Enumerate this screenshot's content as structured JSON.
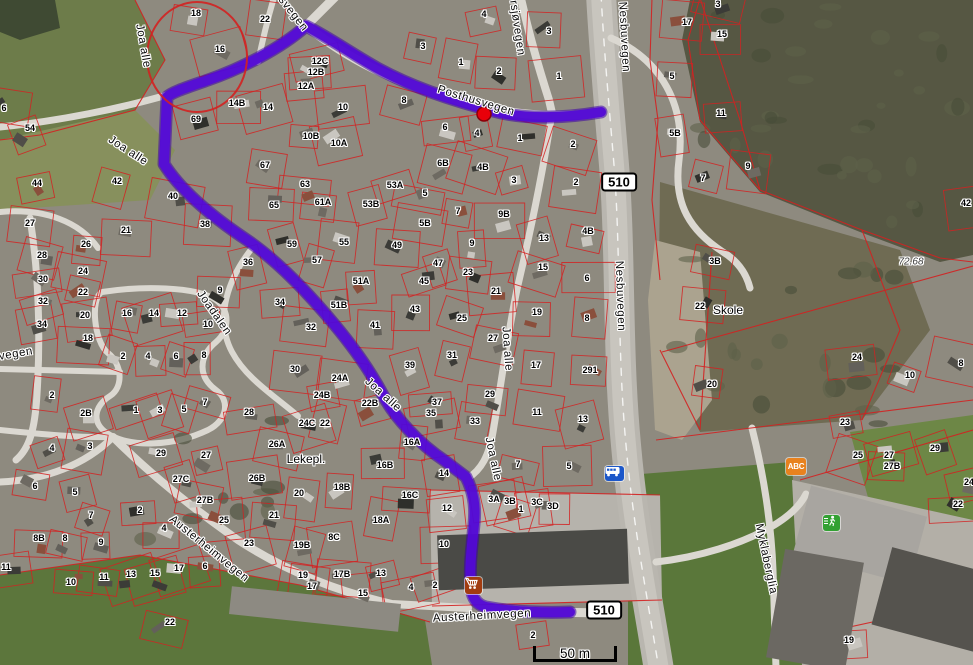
{
  "map": {
    "colors": {
      "route": "#5309d6",
      "route_casing": "#3c00a8",
      "parcel_line": "#d32121",
      "annotation_circle": "#d32121",
      "marker": "#e8000a"
    },
    "streets": [
      {
        "t": "Joa alle",
        "x": 143,
        "y": 46,
        "r": 80
      },
      {
        "t": "Joa alle",
        "x": 128,
        "y": 151,
        "r": 33
      },
      {
        "t": "svegen",
        "x": 293,
        "y": 14,
        "r": 52
      },
      {
        "t": "rsjøvegen",
        "x": 517,
        "y": 28,
        "r": 82
      },
      {
        "t": "Nesbuvegen",
        "x": 624,
        "y": 37,
        "r": 87
      },
      {
        "t": "Posthusvegen",
        "x": 476,
        "y": 101,
        "r": 17
      },
      {
        "t": "vegen",
        "x": 16,
        "y": 354,
        "r": -10
      },
      {
        "t": "Joadalen",
        "x": 214,
        "y": 313,
        "r": 55
      },
      {
        "t": "Joa alle",
        "x": 383,
        "y": 395,
        "r": 42
      },
      {
        "t": "Joa alle",
        "x": 507,
        "y": 349,
        "r": 86
      },
      {
        "t": "Nesbuvegen",
        "x": 620,
        "y": 296,
        "r": 88
      },
      {
        "t": "Joa alle",
        "x": 493,
        "y": 459,
        "r": 78
      },
      {
        "t": "Austerheimvegen",
        "x": 209,
        "y": 549,
        "r": 39
      },
      {
        "t": "Austerheimvegen",
        "x": 482,
        "y": 616,
        "r": -3
      },
      {
        "t": "Myklaberglia",
        "x": 766,
        "y": 559,
        "r": 78
      }
    ],
    "places": [
      {
        "t": "Skole",
        "x": 728,
        "y": 310
      },
      {
        "t": "Lekepl.",
        "x": 306,
        "y": 459
      },
      {
        "t": "72.68",
        "x": 911,
        "y": 262,
        "italic": true
      }
    ],
    "route_shields": [
      {
        "label": "510",
        "x": 619,
        "y": 182
      },
      {
        "label": "510",
        "x": 604,
        "y": 610
      }
    ],
    "icons": {
      "bus_stop": {
        "x": 605,
        "y": 466,
        "color": "#1c57c9"
      },
      "shop": {
        "x": 465,
        "y": 577,
        "color": "#a23c10"
      },
      "kindergarten": {
        "x": 786,
        "y": 458,
        "color": "#e8821e",
        "label": "ABC"
      },
      "sports": {
        "x": 823,
        "y": 515,
        "color": "#33a133"
      }
    },
    "scale_bar": {
      "label": "50 m",
      "x": 533,
      "y": 640,
      "width": 84
    },
    "marker": {
      "x": 484,
      "y": 114
    },
    "annotation_circle": {
      "cx": 197,
      "cy": 57,
      "rx": 50,
      "ry": 55
    },
    "house_numbers": [
      {
        "t": "18",
        "x": 196,
        "y": 13
      },
      {
        "t": "22",
        "x": 265,
        "y": 19
      },
      {
        "t": "16",
        "x": 220,
        "y": 49
      },
      {
        "t": "12C",
        "x": 320,
        "y": 61
      },
      {
        "t": "12B",
        "x": 316,
        "y": 72
      },
      {
        "t": "12A",
        "x": 306,
        "y": 86
      },
      {
        "t": "14B",
        "x": 237,
        "y": 103
      },
      {
        "t": "14",
        "x": 268,
        "y": 107
      },
      {
        "t": "69",
        "x": 196,
        "y": 119
      },
      {
        "t": "10B",
        "x": 311,
        "y": 136
      },
      {
        "t": "54",
        "x": 30,
        "y": 128
      },
      {
        "t": "44",
        "x": 37,
        "y": 183
      },
      {
        "t": "42",
        "x": 117,
        "y": 181
      },
      {
        "t": "40",
        "x": 173,
        "y": 196
      },
      {
        "t": "67",
        "x": 265,
        "y": 165
      },
      {
        "t": "63",
        "x": 305,
        "y": 184
      },
      {
        "t": "65",
        "x": 274,
        "y": 205
      },
      {
        "t": "61A",
        "x": 323,
        "y": 202
      },
      {
        "t": "6",
        "x": 4,
        "y": 108
      },
      {
        "t": "4",
        "x": 484,
        "y": 14
      },
      {
        "t": "3",
        "x": 423,
        "y": 46
      },
      {
        "t": "3",
        "x": 549,
        "y": 31
      },
      {
        "t": "1",
        "x": 461,
        "y": 62
      },
      {
        "t": "2",
        "x": 499,
        "y": 71
      },
      {
        "t": "1",
        "x": 559,
        "y": 76
      },
      {
        "t": "2",
        "x": 573,
        "y": 144
      },
      {
        "t": "8",
        "x": 404,
        "y": 100
      },
      {
        "t": "10",
        "x": 343,
        "y": 107
      },
      {
        "t": "10A",
        "x": 339,
        "y": 143
      },
      {
        "t": "6",
        "x": 445,
        "y": 127
      },
      {
        "t": "4",
        "x": 477,
        "y": 133
      },
      {
        "t": "1",
        "x": 520,
        "y": 138
      },
      {
        "t": "6B",
        "x": 443,
        "y": 163
      },
      {
        "t": "4B",
        "x": 483,
        "y": 167
      },
      {
        "t": "3",
        "x": 514,
        "y": 180
      },
      {
        "t": "2",
        "x": 576,
        "y": 182
      },
      {
        "t": "53A",
        "x": 395,
        "y": 185
      },
      {
        "t": "53B",
        "x": 371,
        "y": 204
      },
      {
        "t": "5",
        "x": 425,
        "y": 193
      },
      {
        "t": "7",
        "x": 458,
        "y": 211
      },
      {
        "t": "9B",
        "x": 504,
        "y": 214
      },
      {
        "t": "3",
        "x": 718,
        "y": 4
      },
      {
        "t": "17",
        "x": 687,
        "y": 22
      },
      {
        "t": "15",
        "x": 722,
        "y": 34
      },
      {
        "t": "5",
        "x": 672,
        "y": 76
      },
      {
        "t": "11",
        "x": 721,
        "y": 113
      },
      {
        "t": "5B",
        "x": 675,
        "y": 133
      },
      {
        "t": "9",
        "x": 748,
        "y": 166
      },
      {
        "t": "7",
        "x": 703,
        "y": 178
      },
      {
        "t": "42",
        "x": 966,
        "y": 203
      },
      {
        "t": "27",
        "x": 30,
        "y": 223
      },
      {
        "t": "21",
        "x": 126,
        "y": 230
      },
      {
        "t": "38",
        "x": 205,
        "y": 224
      },
      {
        "t": "26",
        "x": 86,
        "y": 244
      },
      {
        "t": "28",
        "x": 42,
        "y": 255
      },
      {
        "t": "59",
        "x": 292,
        "y": 244
      },
      {
        "t": "57",
        "x": 317,
        "y": 260
      },
      {
        "t": "24",
        "x": 83,
        "y": 271
      },
      {
        "t": "30",
        "x": 43,
        "y": 279
      },
      {
        "t": "36",
        "x": 248,
        "y": 262
      },
      {
        "t": "22",
        "x": 83,
        "y": 292
      },
      {
        "t": "32",
        "x": 43,
        "y": 301
      },
      {
        "t": "20",
        "x": 85,
        "y": 315
      },
      {
        "t": "34",
        "x": 42,
        "y": 324
      },
      {
        "t": "9",
        "x": 220,
        "y": 290
      },
      {
        "t": "18",
        "x": 88,
        "y": 338
      },
      {
        "t": "16",
        "x": 127,
        "y": 313
      },
      {
        "t": "14",
        "x": 154,
        "y": 313
      },
      {
        "t": "12",
        "x": 182,
        "y": 313
      },
      {
        "t": "10",
        "x": 208,
        "y": 324
      },
      {
        "t": "34",
        "x": 280,
        "y": 302
      },
      {
        "t": "32",
        "x": 311,
        "y": 327
      },
      {
        "t": "2",
        "x": 123,
        "y": 356
      },
      {
        "t": "4",
        "x": 148,
        "y": 356
      },
      {
        "t": "6",
        "x": 176,
        "y": 356
      },
      {
        "t": "8",
        "x": 204,
        "y": 355
      },
      {
        "t": "30",
        "x": 295,
        "y": 369
      },
      {
        "t": "2",
        "x": 52,
        "y": 395
      },
      {
        "t": "2B",
        "x": 86,
        "y": 413
      },
      {
        "t": "1",
        "x": 136,
        "y": 410
      },
      {
        "t": "3",
        "x": 160,
        "y": 410
      },
      {
        "t": "5",
        "x": 184,
        "y": 409
      },
      {
        "t": "7",
        "x": 205,
        "y": 402
      },
      {
        "t": "28",
        "x": 249,
        "y": 412
      },
      {
        "t": "24B",
        "x": 322,
        "y": 395
      },
      {
        "t": "24C",
        "x": 307,
        "y": 423
      },
      {
        "t": "22",
        "x": 325,
        "y": 423
      },
      {
        "t": "55",
        "x": 344,
        "y": 242
      },
      {
        "t": "49",
        "x": 397,
        "y": 245
      },
      {
        "t": "5B",
        "x": 425,
        "y": 223
      },
      {
        "t": "9",
        "x": 472,
        "y": 243
      },
      {
        "t": "13",
        "x": 544,
        "y": 238
      },
      {
        "t": "4B",
        "x": 588,
        "y": 231
      },
      {
        "t": "47",
        "x": 438,
        "y": 263
      },
      {
        "t": "23",
        "x": 468,
        "y": 272
      },
      {
        "t": "51A",
        "x": 361,
        "y": 281
      },
      {
        "t": "45",
        "x": 424,
        "y": 281
      },
      {
        "t": "15",
        "x": 543,
        "y": 267
      },
      {
        "t": "6",
        "x": 587,
        "y": 278
      },
      {
        "t": "21",
        "x": 496,
        "y": 291
      },
      {
        "t": "51B",
        "x": 339,
        "y": 305
      },
      {
        "t": "43",
        "x": 415,
        "y": 309
      },
      {
        "t": "19",
        "x": 537,
        "y": 312
      },
      {
        "t": "25",
        "x": 462,
        "y": 318
      },
      {
        "t": "8",
        "x": 587,
        "y": 318
      },
      {
        "t": "41",
        "x": 375,
        "y": 325
      },
      {
        "t": "27",
        "x": 493,
        "y": 338
      },
      {
        "t": "31",
        "x": 452,
        "y": 355
      },
      {
        "t": "17",
        "x": 536,
        "y": 365
      },
      {
        "t": "291",
        "x": 590,
        "y": 370
      },
      {
        "t": "39",
        "x": 410,
        "y": 365
      },
      {
        "t": "24A",
        "x": 340,
        "y": 378
      },
      {
        "t": "29",
        "x": 490,
        "y": 394
      },
      {
        "t": "22B",
        "x": 370,
        "y": 403
      },
      {
        "t": "37",
        "x": 437,
        "y": 402
      },
      {
        "t": "35",
        "x": 431,
        "y": 413
      },
      {
        "t": "33",
        "x": 475,
        "y": 421
      },
      {
        "t": "11",
        "x": 537,
        "y": 412
      },
      {
        "t": "13",
        "x": 583,
        "y": 419
      },
      {
        "t": "3B",
        "x": 715,
        "y": 261
      },
      {
        "t": "22",
        "x": 700,
        "y": 306
      },
      {
        "t": "24",
        "x": 857,
        "y": 357
      },
      {
        "t": "10",
        "x": 910,
        "y": 375
      },
      {
        "t": "8",
        "x": 961,
        "y": 363
      },
      {
        "t": "20",
        "x": 712,
        "y": 384
      },
      {
        "t": "23",
        "x": 845,
        "y": 422
      },
      {
        "t": "4",
        "x": 52,
        "y": 448
      },
      {
        "t": "3",
        "x": 90,
        "y": 446
      },
      {
        "t": "29",
        "x": 161,
        "y": 453
      },
      {
        "t": "27",
        "x": 206,
        "y": 455
      },
      {
        "t": "26A",
        "x": 277,
        "y": 444
      },
      {
        "t": "6",
        "x": 35,
        "y": 486
      },
      {
        "t": "5",
        "x": 75,
        "y": 492
      },
      {
        "t": "27C",
        "x": 181,
        "y": 479
      },
      {
        "t": "26B",
        "x": 257,
        "y": 478
      },
      {
        "t": "20",
        "x": 299,
        "y": 493
      },
      {
        "t": "7",
        "x": 91,
        "y": 515
      },
      {
        "t": "2",
        "x": 140,
        "y": 510
      },
      {
        "t": "27B",
        "x": 205,
        "y": 500
      },
      {
        "t": "4",
        "x": 164,
        "y": 528
      },
      {
        "t": "25",
        "x": 224,
        "y": 520
      },
      {
        "t": "21",
        "x": 274,
        "y": 515
      },
      {
        "t": "8B",
        "x": 39,
        "y": 538
      },
      {
        "t": "8",
        "x": 65,
        "y": 538
      },
      {
        "t": "9",
        "x": 101,
        "y": 542
      },
      {
        "t": "23",
        "x": 249,
        "y": 543
      },
      {
        "t": "19B",
        "x": 302,
        "y": 545
      },
      {
        "t": "11",
        "x": 6,
        "y": 567
      },
      {
        "t": "10",
        "x": 71,
        "y": 582
      },
      {
        "t": "11",
        "x": 104,
        "y": 577
      },
      {
        "t": "13",
        "x": 131,
        "y": 574
      },
      {
        "t": "15",
        "x": 155,
        "y": 573
      },
      {
        "t": "17",
        "x": 179,
        "y": 568
      },
      {
        "t": "6",
        "x": 205,
        "y": 566
      },
      {
        "t": "19",
        "x": 303,
        "y": 575
      },
      {
        "t": "17",
        "x": 312,
        "y": 586
      },
      {
        "t": "22",
        "x": 170,
        "y": 622
      },
      {
        "t": "16A",
        "x": 412,
        "y": 442
      },
      {
        "t": "16B",
        "x": 385,
        "y": 465
      },
      {
        "t": "14",
        "x": 444,
        "y": 473
      },
      {
        "t": "7",
        "x": 518,
        "y": 464
      },
      {
        "t": "5",
        "x": 569,
        "y": 466
      },
      {
        "t": "18B",
        "x": 342,
        "y": 487
      },
      {
        "t": "16C",
        "x": 410,
        "y": 495
      },
      {
        "t": "3A",
        "x": 494,
        "y": 499
      },
      {
        "t": "3B",
        "x": 510,
        "y": 501
      },
      {
        "t": "3C",
        "x": 537,
        "y": 502
      },
      {
        "t": "3D",
        "x": 553,
        "y": 506
      },
      {
        "t": "1",
        "x": 521,
        "y": 509
      },
      {
        "t": "18A",
        "x": 381,
        "y": 520
      },
      {
        "t": "12",
        "x": 447,
        "y": 508
      },
      {
        "t": "8C",
        "x": 334,
        "y": 537
      },
      {
        "t": "10",
        "x": 444,
        "y": 544
      },
      {
        "t": "17B",
        "x": 342,
        "y": 574
      },
      {
        "t": "13",
        "x": 381,
        "y": 573
      },
      {
        "t": "4",
        "x": 411,
        "y": 587
      },
      {
        "t": "2",
        "x": 435,
        "y": 585
      },
      {
        "t": "15",
        "x": 363,
        "y": 593
      },
      {
        "t": "2",
        "x": 533,
        "y": 635
      },
      {
        "t": "25",
        "x": 858,
        "y": 455
      },
      {
        "t": "27",
        "x": 889,
        "y": 455
      },
      {
        "t": "27B",
        "x": 892,
        "y": 466
      },
      {
        "t": "29",
        "x": 935,
        "y": 448
      },
      {
        "t": "24",
        "x": 969,
        "y": 482
      },
      {
        "t": "22",
        "x": 958,
        "y": 504
      },
      {
        "t": "19",
        "x": 849,
        "y": 640
      }
    ]
  }
}
